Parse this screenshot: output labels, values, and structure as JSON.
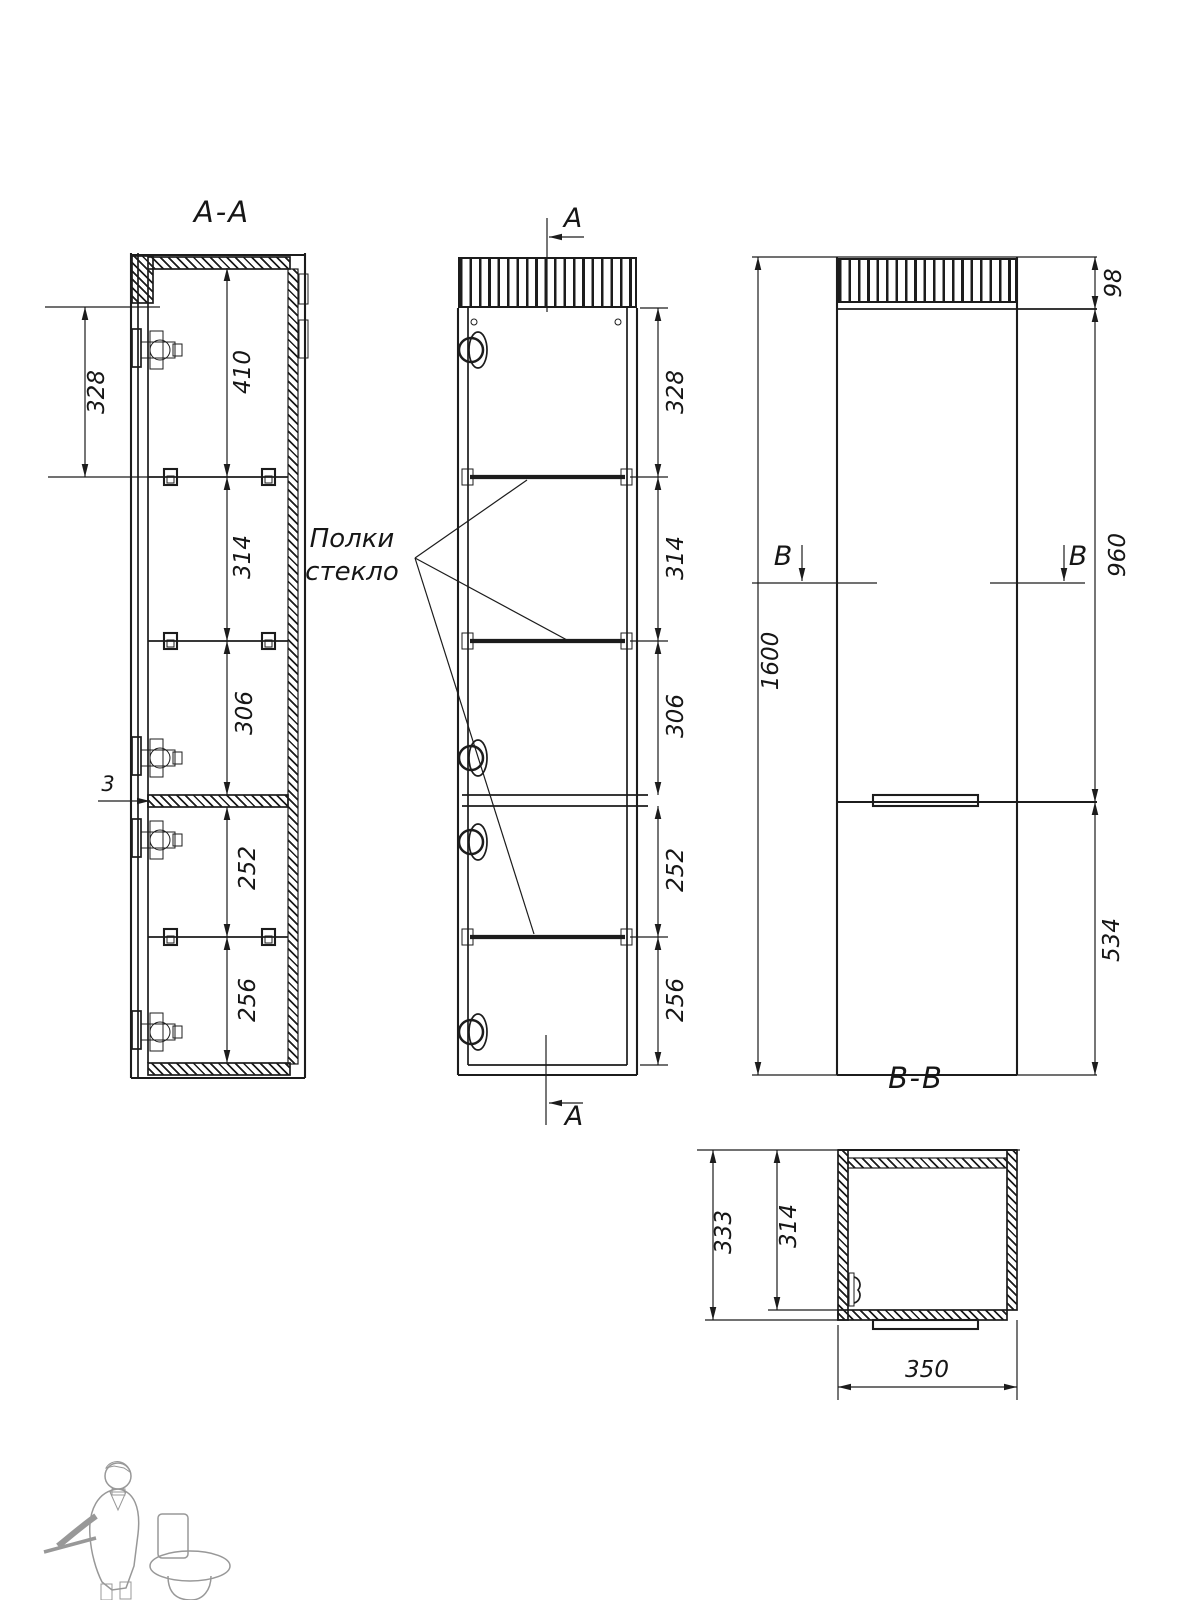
{
  "drawing": {
    "section_aa": {
      "label": "A-A",
      "offset_dim": "328",
      "chain": [
        "410",
        "314",
        "306",
        "252",
        "256"
      ],
      "shelf_gap": "3"
    },
    "front_view": {
      "section_marker": "A",
      "glass_note_line1": "Полки",
      "glass_note_line2": "стекло",
      "chain": [
        "328",
        "314",
        "306",
        "252",
        "256"
      ]
    },
    "side_view": {
      "section_marker": "B",
      "overall_height": "1600",
      "grille_height": "98",
      "upper_door_height": "960",
      "lower_door_height": "534"
    },
    "section_bb": {
      "label": "B-B",
      "outer_depth": "333",
      "inner_depth": "314",
      "width": "350"
    },
    "colors": {
      "line": "#1c1c1c",
      "background": "#ffffff",
      "watermark": "#c9c9c9"
    }
  }
}
